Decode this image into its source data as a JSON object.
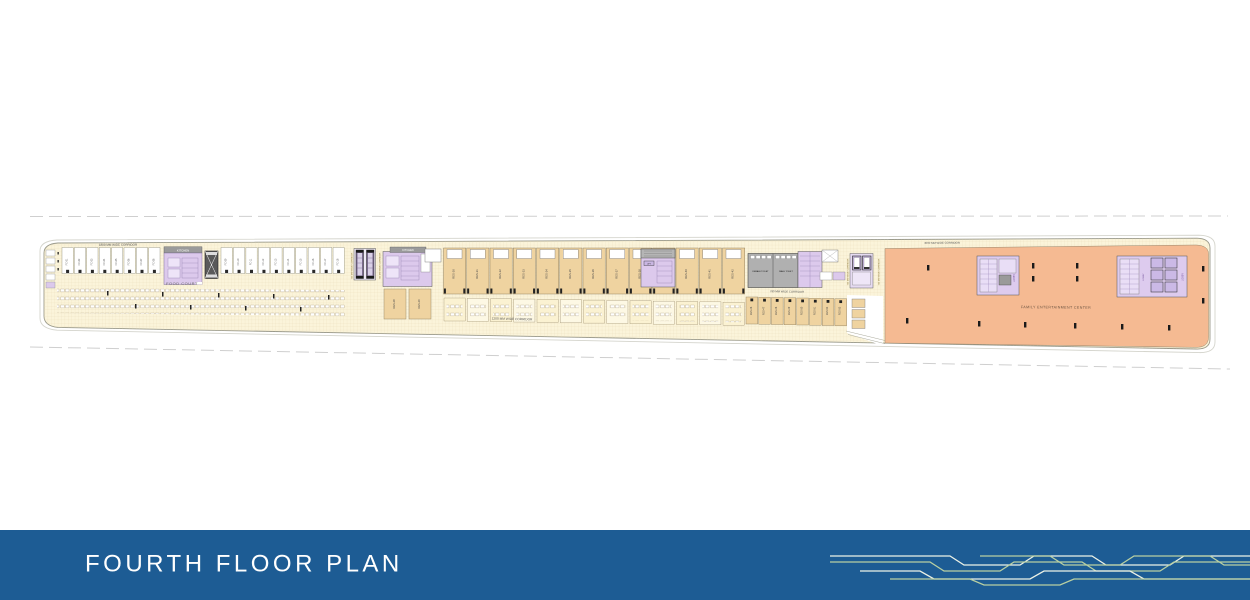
{
  "footer": {
    "title": "FOURTH FLOOR PLAN",
    "bar_color": "#1d5c94",
    "text_color": "#ffffff",
    "trace_colors": [
      "#b9d0a2",
      "#ecf2e6"
    ]
  },
  "plan": {
    "labels": {
      "food_court": "FOOD COURT",
      "family_entertainment": "FAMILY ENTERTAINMENT CENTER",
      "kitchen": "KITCHEN",
      "female_toilet": "FEMALE TOILET",
      "male_toilet": "MALE TOILET",
      "lobby": "LOBBY",
      "lift": "LIFT"
    },
    "corridors": {
      "top_left": "1800 MM WIDE CORRIDOR",
      "bottom_mid": "1200 MM WIDE CORRIDOR",
      "toilet_front": "780 MM WIDE CORRIDOR",
      "fec_top": "4000 MM WIDE CORRIDOR",
      "vertical": "750 MM WIDE CORRIDOR"
    },
    "units": {
      "food_stalls_left": [
        "FC-01",
        "FC-02",
        "FC-03",
        "FC-04",
        "FC-05",
        "FC-06",
        "FC-07",
        "FC-08"
      ],
      "food_stalls_right": [
        "FC-09",
        "FC-10",
        "FC-11",
        "FC-12",
        "FC-13",
        "FC-14",
        "FC-15",
        "FC-16",
        "FC-17",
        "FC-18"
      ],
      "restaurants": [
        "RES-30",
        "RES-31",
        "RES-32",
        "RES-33",
        "RES-34",
        "RES-35",
        "RES-36",
        "RES-37",
        "RES-38",
        "RES-39",
        "RES-40",
        "RES-41",
        "RES-42"
      ],
      "restaurants_small": [
        "RES-28",
        "RES-29"
      ],
      "retail": [
        "RES-46",
        "RES-47",
        "RES-48",
        "RES-49",
        "RES-50",
        "RES-51",
        "RES-52",
        "RES-53"
      ]
    },
    "colors": {
      "plan_cream": "#fbf4da",
      "unit_tan": "#efd3a0",
      "fec_salmon": "#f5ba92",
      "block_purple": "#dcc9ec",
      "toilet_gray": "#b0b0b0",
      "grid_line": "#e6d9b4",
      "outline": "#98988a",
      "dashed_line": "#cfcfcf"
    }
  }
}
